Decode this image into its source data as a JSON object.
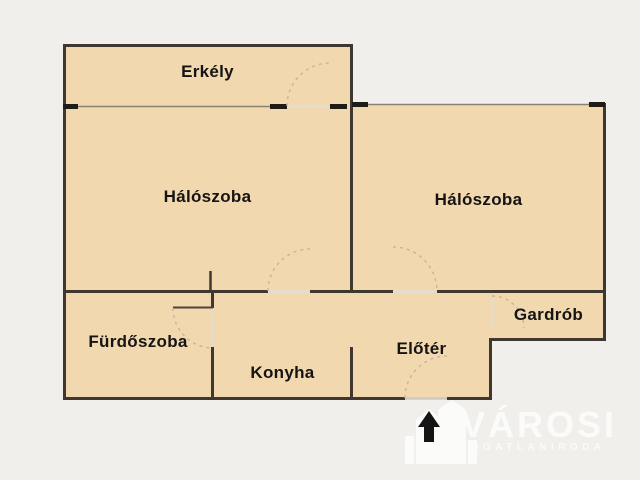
{
  "floorplan": {
    "rooms": [
      {
        "id": "erkely",
        "label": "Erkély"
      },
      {
        "id": "haloszoba-1",
        "label": "Hálószoba"
      },
      {
        "id": "haloszoba-2",
        "label": "Hálószoba"
      },
      {
        "id": "furdoszoba",
        "label": "Fürdőszoba"
      },
      {
        "id": "konyha",
        "label": "Konyha"
      },
      {
        "id": "eloter",
        "label": "Előtér"
      },
      {
        "id": "gardrob",
        "label": "Gardrób"
      }
    ]
  },
  "watermark": {
    "brand": "VÁROSI",
    "subtitle": "INGATLANIRODA"
  },
  "colors": {
    "background": "#f0efeb",
    "room_fill": "#f2d8ae",
    "wall": "#3e3831",
    "wall_stub": "#1f1b16",
    "window_line": "#8d8172",
    "door_arc": "#c6b49c",
    "threshold": "#e3dcd2",
    "label_text": "#141414",
    "watermark_text": "#fbfbf9"
  }
}
